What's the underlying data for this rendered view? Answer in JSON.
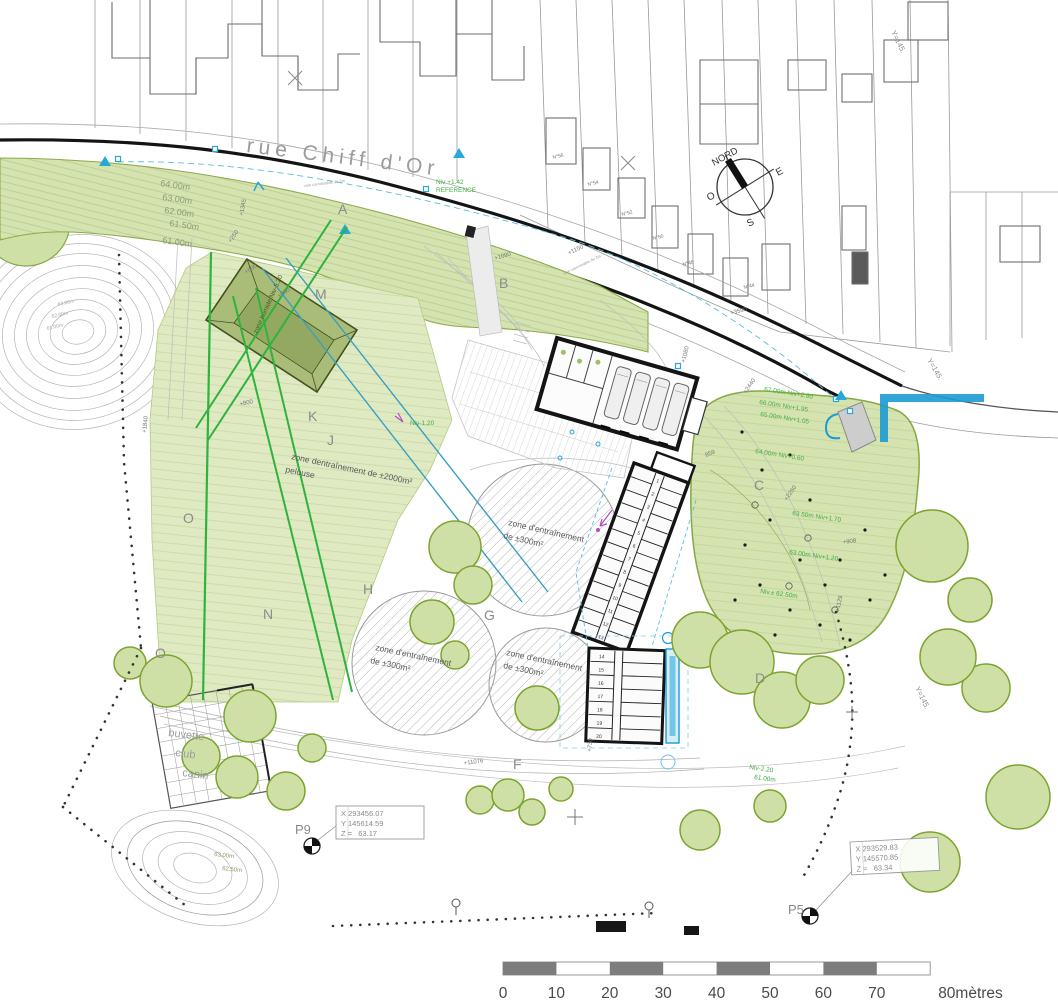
{
  "colors": {
    "tree_fill": "#cfe0a6",
    "tree_outline": "#7ca42f",
    "band_fill": "#d4e3b0",
    "field_fill": "#dfe9c2",
    "road_black": "#141414",
    "cyan": "#28a7d8",
    "cyan_deep": "#1d9ad2",
    "annotation_green": "#46ae46",
    "bright_green": "#2fb33c",
    "teal": "#3a9fc0",
    "magenta": "#b44fc0",
    "scale_gray": "#7d7d7d",
    "dark_building": "#a9bc78"
  },
  "scale_bar": {
    "x0": 503,
    "dx": 53.4,
    "y_label": 998,
    "labels": [
      {
        "t": "0"
      },
      {
        "t": "10"
      },
      {
        "t": "20"
      },
      {
        "t": "30"
      },
      {
        "t": "40"
      },
      {
        "t": "50"
      },
      {
        "t": "60"
      },
      {
        "t": "70"
      },
      {
        "t": "80mètres",
        "anchor": "start",
        "off": 8
      }
    ]
  },
  "buildings": {
    "kennel_a_cells": [
      "1",
      "2",
      "3",
      "4",
      "5",
      "6",
      "7",
      "8",
      "9",
      "10",
      "11",
      "12",
      "13"
    ],
    "kennel_b_cells": [
      "14",
      "15",
      "16",
      "17",
      "18",
      "19",
      "20"
    ]
  },
  "labels": [
    {
      "name": "street-name",
      "text": "rue Chiff d'Or",
      "x": 246,
      "y": 152,
      "rot": 7,
      "size": 21,
      "color": "#9b9b9b",
      "ls": 5
    },
    {
      "name": "compass-label-nord",
      "text": "NORD",
      "x": 714,
      "y": 166,
      "rot": -29,
      "size": 9.5,
      "color": "#333"
    },
    {
      "name": "compass-label-e",
      "text": "E",
      "x": 778,
      "y": 176,
      "rot": -29,
      "size": 10,
      "color": "#333"
    },
    {
      "name": "compass-label-o",
      "text": "O",
      "x": 709,
      "y": 201,
      "rot": -29,
      "size": 10,
      "color": "#333"
    },
    {
      "name": "compass-label-s",
      "text": "S",
      "x": 749,
      "y": 227,
      "rot": -29,
      "size": 10,
      "color": "#333"
    },
    {
      "name": "elevation-label",
      "text": "64.00m",
      "x": 160,
      "y": 186,
      "rot": 8,
      "size": 9,
      "color": "#8e9c79"
    },
    {
      "name": "elevation-label",
      "text": "63.00m",
      "x": 162,
      "y": 200,
      "rot": 8,
      "size": 9,
      "color": "#8e9c79"
    },
    {
      "name": "elevation-label",
      "text": "62.00m",
      "x": 164,
      "y": 213,
      "rot": 8,
      "size": 9,
      "color": "#8e9c79"
    },
    {
      "name": "elevation-label",
      "text": "61.50m",
      "x": 169,
      "y": 226,
      "rot": 8,
      "size": 9,
      "color": "#8e9c79"
    },
    {
      "name": "elevation-label",
      "text": "61.00m",
      "x": 162,
      "y": 243,
      "rot": 8,
      "size": 9,
      "color": "#8e9c79"
    },
    {
      "name": "contour-label",
      "text": "63.00m",
      "x": 58,
      "y": 306,
      "rot": -12,
      "size": 5,
      "color": "#a8a8a8"
    },
    {
      "name": "contour-label",
      "text": "62.00m",
      "x": 52,
      "y": 318,
      "rot": -12,
      "size": 5,
      "color": "#a8a8a8"
    },
    {
      "name": "contour-label",
      "text": "61.00m",
      "x": 47,
      "y": 330,
      "rot": -12,
      "size": 5,
      "color": "#a8a8a8"
    },
    {
      "name": "contour-label",
      "text": "63.00m",
      "x": 214,
      "y": 856,
      "rot": 6,
      "size": 6,
      "color": "#8a9a6a"
    },
    {
      "name": "contour-label",
      "text": "62.50m",
      "x": 222,
      "y": 870,
      "rot": 6,
      "size": 6,
      "color": "#8a9a6a"
    },
    {
      "name": "level-label",
      "text": "67.00m Niv+2.80",
      "x": 764,
      "y": 391,
      "rot": 9,
      "size": 6.5,
      "color": "#46ae46"
    },
    {
      "name": "level-label",
      "text": "66.00m Niv+1.95",
      "x": 759,
      "y": 404,
      "rot": 9,
      "size": 6.5,
      "color": "#46ae46"
    },
    {
      "name": "level-label",
      "text": "65.00m Niv+1.05",
      "x": 760,
      "y": 416,
      "rot": 9,
      "size": 6.5,
      "color": "#46ae46"
    },
    {
      "name": "level-label",
      "text": "64.00m Niv+0.60",
      "x": 755,
      "y": 453,
      "rot": 9,
      "size": 6.5,
      "color": "#46ae46"
    },
    {
      "name": "level-label",
      "text": "63.50m Niv+1.70",
      "x": 792,
      "y": 515,
      "rot": 8,
      "size": 6.5,
      "color": "#46ae46"
    },
    {
      "name": "level-label",
      "text": "63.00m Niv+1.20",
      "x": 789,
      "y": 554,
      "rot": 8,
      "size": 6.5,
      "color": "#46ae46"
    },
    {
      "name": "level-label",
      "text": "Niv.± 62.50m",
      "x": 760,
      "y": 593,
      "rot": 8,
      "size": 6.5,
      "color": "#46ae46"
    },
    {
      "name": "level-label",
      "text": "Niv-2.20",
      "x": 749,
      "y": 769,
      "rot": 8,
      "size": 6.5,
      "color": "#46ae46"
    },
    {
      "name": "level-label",
      "text": "61.00m",
      "x": 754,
      "y": 779,
      "rot": 8,
      "size": 6.5,
      "color": "#46ae46"
    },
    {
      "name": "reference-level",
      "text": "Niv +1.42",
      "x": 436,
      "y": 184,
      "rot": 0,
      "size": 6.5,
      "color": "#3fae3f"
    },
    {
      "name": "reference-level",
      "text": "REFERENCE",
      "x": 436,
      "y": 192,
      "rot": 0,
      "size": 6.5,
      "color": "#3fae3f"
    },
    {
      "name": "level-label",
      "text": "Niv-1.20",
      "x": 410,
      "y": 425,
      "rot": 0,
      "size": 6.5,
      "color": "#3fae3f"
    },
    {
      "name": "zone-humide-label",
      "text": "zone humide Niv-5.20",
      "x": 257,
      "y": 334,
      "rot": -66,
      "size": 6.5,
      "color": "#44601e"
    },
    {
      "name": "training-zone-label",
      "text": "zone dentraînement de ±2000m²",
      "x": 291,
      "y": 459,
      "rot": 12,
      "size": 8.5,
      "color": "#5a5a5a"
    },
    {
      "name": "training-zone-label",
      "text": "pelouse",
      "x": 285,
      "y": 472,
      "rot": 12,
      "size": 8.5,
      "color": "#5a5a5a"
    },
    {
      "name": "training-zone-label",
      "text": "zone d'entraînement",
      "x": 508,
      "y": 525,
      "rot": 13,
      "size": 8.5,
      "color": "#5a5a5a"
    },
    {
      "name": "training-zone-label",
      "text": "de ±300m²",
      "x": 503,
      "y": 538,
      "rot": 13,
      "size": 8.5,
      "color": "#5a5a5a"
    },
    {
      "name": "training-zone-label",
      "text": "zone d'entraînement",
      "x": 375,
      "y": 650,
      "rot": 12,
      "size": 8.5,
      "color": "#5a5a5a"
    },
    {
      "name": "training-zone-label",
      "text": "de ±300m²",
      "x": 370,
      "y": 663,
      "rot": 12,
      "size": 8.5,
      "color": "#5a5a5a"
    },
    {
      "name": "training-zone-label",
      "text": "zone d'entraînement",
      "x": 506,
      "y": 655,
      "rot": 12,
      "size": 8.5,
      "color": "#5a5a5a"
    },
    {
      "name": "training-zone-label",
      "text": "de ±300m²",
      "x": 503,
      "y": 668,
      "rot": 12,
      "size": 8.5,
      "color": "#5a5a5a"
    },
    {
      "name": "buvette-label",
      "text": "buvette",
      "x": 168,
      "y": 736,
      "rot": 7,
      "size": 11,
      "color": "#9c9c9c"
    },
    {
      "name": "buvette-label",
      "text": "club",
      "x": 175,
      "y": 756,
      "rot": 7,
      "size": 11,
      "color": "#9c9c9c"
    },
    {
      "name": "buvette-label",
      "text": "canin",
      "x": 182,
      "y": 776,
      "rot": 7,
      "size": 11,
      "color": "#9c9c9c"
    },
    {
      "name": "zone-letter",
      "text": "A",
      "x": 338,
      "y": 214,
      "size": 14,
      "color": "#8c8c8c"
    },
    {
      "name": "zone-letter",
      "text": "B",
      "x": 499,
      "y": 288,
      "size": 14,
      "color": "#8c8c8c"
    },
    {
      "name": "zone-letter",
      "text": "M",
      "x": 315,
      "y": 299,
      "size": 14,
      "color": "#8c8c8c"
    },
    {
      "name": "zone-letter",
      "text": "K",
      "x": 308,
      "y": 421,
      "size": 14,
      "color": "#8c8c8c"
    },
    {
      "name": "zone-letter",
      "text": "J",
      "x": 327,
      "y": 445,
      "size": 14,
      "color": "#8c8c8c"
    },
    {
      "name": "zone-letter",
      "text": "O",
      "x": 183,
      "y": 523,
      "size": 14,
      "color": "#8c8c8c"
    },
    {
      "name": "zone-letter",
      "text": "O",
      "x": 155,
      "y": 658,
      "size": 14,
      "color": "#8c8c8c"
    },
    {
      "name": "zone-letter",
      "text": "N",
      "x": 263,
      "y": 619,
      "size": 14,
      "color": "#8c8c8c"
    },
    {
      "name": "zone-letter",
      "text": "H",
      "x": 363,
      "y": 594,
      "size": 14,
      "color": "#8c8c8c"
    },
    {
      "name": "zone-letter",
      "text": "G",
      "x": 484,
      "y": 620,
      "size": 14,
      "color": "#8c8c8c"
    },
    {
      "name": "zone-letter",
      "text": "C",
      "x": 754,
      "y": 490,
      "size": 14,
      "color": "#8c8c8c"
    },
    {
      "name": "zone-letter",
      "text": "D",
      "x": 755,
      "y": 683,
      "size": 14,
      "color": "#8c8c8c"
    },
    {
      "name": "zone-letter",
      "text": "F",
      "x": 513,
      "y": 769,
      "size": 14,
      "color": "#8c8c8c"
    },
    {
      "name": "house-number",
      "text": "N°56",
      "x": 553,
      "y": 159,
      "rot": -14,
      "size": 5,
      "color": "#777"
    },
    {
      "name": "house-number",
      "text": "N°54",
      "x": 588,
      "y": 186,
      "rot": -14,
      "size": 5,
      "color": "#777"
    },
    {
      "name": "house-number",
      "text": "N°52",
      "x": 622,
      "y": 216,
      "rot": -14,
      "size": 5,
      "color": "#777"
    },
    {
      "name": "house-number",
      "text": "N°50",
      "x": 653,
      "y": 240,
      "rot": -14,
      "size": 5,
      "color": "#777"
    },
    {
      "name": "house-number",
      "text": "N°48",
      "x": 683,
      "y": 266,
      "rot": -14,
      "size": 5,
      "color": "#777"
    },
    {
      "name": "house-number",
      "text": "N°44",
      "x": 744,
      "y": 289,
      "rot": -14,
      "size": 5,
      "color": "#777"
    },
    {
      "name": "dimension-label",
      "text": "+1345",
      "x": 243,
      "y": 216,
      "rot": -80,
      "size": 6,
      "color": "#777"
    },
    {
      "name": "dimension-label",
      "text": "+250",
      "x": 231,
      "y": 243,
      "rot": -55,
      "size": 6,
      "color": "#777"
    },
    {
      "name": "dimension-label",
      "text": "+600",
      "x": 246,
      "y": 274,
      "rot": -33,
      "size": 6,
      "color": "#777"
    },
    {
      "name": "dimension-label",
      "text": "+800",
      "x": 279,
      "y": 298,
      "rot": -33,
      "size": 6,
      "color": "#777"
    },
    {
      "name": "dimension-label",
      "text": "+800",
      "x": 240,
      "y": 406,
      "rot": -12,
      "size": 6,
      "color": "#777"
    },
    {
      "name": "dimension-label",
      "text": "+1840",
      "x": 146,
      "y": 433,
      "rot": -84,
      "size": 6,
      "color": "#777"
    },
    {
      "name": "dimension-label",
      "text": "+1090",
      "x": 495,
      "y": 260,
      "rot": -16,
      "size": 6,
      "color": "#777"
    },
    {
      "name": "dimension-label",
      "text": "+1150",
      "x": 569,
      "y": 255,
      "rot": -26,
      "size": 6,
      "color": "#777"
    },
    {
      "name": "dimension-label",
      "text": "+3590",
      "x": 731,
      "y": 315,
      "rot": -15,
      "size": 6,
      "color": "#777"
    },
    {
      "name": "dimension-label",
      "text": "+1080",
      "x": 685,
      "y": 363,
      "rot": -77,
      "size": 6,
      "color": "#777"
    },
    {
      "name": "dimension-label",
      "text": "859",
      "x": 706,
      "y": 457,
      "rot": -22,
      "size": 6,
      "color": "#777"
    },
    {
      "name": "dimension-label",
      "text": "+2440",
      "x": 746,
      "y": 394,
      "rot": -55,
      "size": 6,
      "color": "#777"
    },
    {
      "name": "dimension-label",
      "text": "+2260",
      "x": 787,
      "y": 501,
      "rot": -55,
      "size": 6,
      "color": "#777"
    },
    {
      "name": "dimension-label",
      "text": "+908",
      "x": 843,
      "y": 544,
      "rot": -8,
      "size": 6,
      "color": "#777"
    },
    {
      "name": "dimension-label",
      "text": "+1129",
      "x": 839,
      "y": 612,
      "rot": -78,
      "size": 6,
      "color": "#777"
    },
    {
      "name": "dimension-label",
      "text": "+11076",
      "x": 464,
      "y": 765,
      "rot": -8,
      "size": 6,
      "color": "#777"
    },
    {
      "name": "dimension-label",
      "text": "+730",
      "x": 591,
      "y": 752,
      "rot": -84,
      "size": 6,
      "color": "#777"
    },
    {
      "name": "road-note",
      "text": "voie carrossable de 2m",
      "x": 304,
      "y": 187,
      "rot": -7,
      "size": 4,
      "color": "#999"
    },
    {
      "name": "road-note",
      "text": "voie carrossable de 2m",
      "x": 564,
      "y": 275,
      "rot": -26,
      "size": 4,
      "color": "#999"
    },
    {
      "name": "grid-coordinate",
      "text": "Y=145.",
      "x": 891,
      "y": 32,
      "rot": 64,
      "size": 7.5,
      "color": "#8c8c8c"
    },
    {
      "name": "grid-coordinate",
      "text": "Y=145.",
      "x": 927,
      "y": 360,
      "rot": 60,
      "size": 7.5,
      "color": "#8c8c8c"
    },
    {
      "name": "grid-coordinate",
      "text": "Y=145.",
      "x": 915,
      "y": 688,
      "rot": 64,
      "size": 7.5,
      "color": "#8c8c8c"
    },
    {
      "name": "survey-point-id",
      "text": "P9",
      "x": 295,
      "y": 834,
      "size": 13,
      "color": "#8a8a8a"
    },
    {
      "name": "survey-point-id",
      "text": "P5",
      "x": 788,
      "y": 914,
      "size": 13,
      "color": "#8a8a8a"
    },
    {
      "name": "survey-coord-x",
      "text": "X 293456.07",
      "x": 341,
      "y": 816,
      "size": 7.5,
      "color": "#8a8a8a",
      "mono": true
    },
    {
      "name": "survey-coord-y",
      "text": "Y 145614.59",
      "x": 341,
      "y": 826,
      "size": 7.5,
      "color": "#8a8a8a",
      "mono": true
    },
    {
      "name": "survey-coord-z",
      "text": "Z =   63.17",
      "x": 341,
      "y": 836,
      "size": 7.5,
      "color": "#8a8a8a",
      "mono": true
    },
    {
      "name": "survey-coord-x",
      "text": "X 293529.83",
      "x": 855,
      "y": 852,
      "size": 7.5,
      "color": "#8a8a8a",
      "mono": true,
      "layer": "p5box"
    },
    {
      "name": "survey-coord-y",
      "text": "Y 145570.85",
      "x": 855,
      "y": 862,
      "size": 7.5,
      "color": "#8a8a8a",
      "mono": true,
      "layer": "p5box"
    },
    {
      "name": "survey-coord-z",
      "text": "Z =   63.34",
      "x": 855,
      "y": 872,
      "size": 7.5,
      "color": "#8a8a8a",
      "mono": true,
      "layer": "p5box"
    }
  ]
}
